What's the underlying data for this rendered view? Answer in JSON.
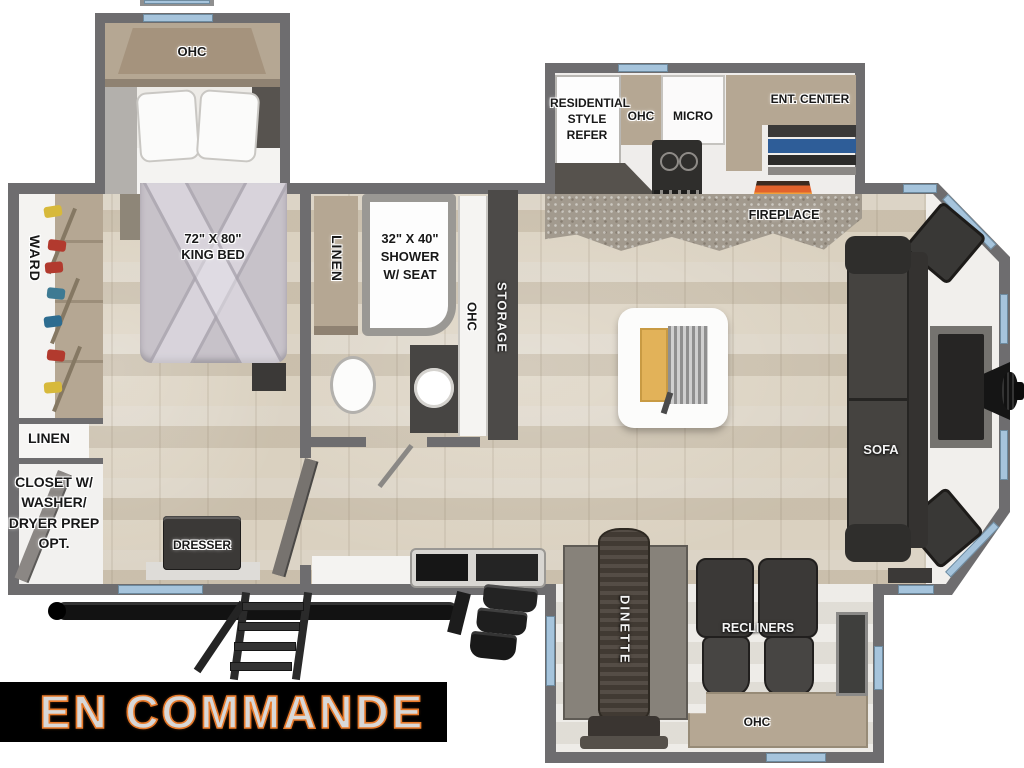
{
  "plan": {
    "bedroom": {
      "slide_ohc": "OHC",
      "king_bed": [
        "72\" X 80\"",
        "KING BED"
      ],
      "ward": "WARD",
      "linen": "LINEN",
      "closet": [
        "CLOSET W/",
        "WASHER/",
        "DRYER PREP",
        "OPT."
      ],
      "dresser": "DRESSER"
    },
    "bathroom": {
      "linen": "LINEN",
      "shower": [
        "32\" X 40\"",
        "SHOWER",
        "W/ SEAT"
      ]
    },
    "hall": {
      "ohc": "OHC",
      "storage": "STORAGE"
    },
    "kitchen": {
      "refer": [
        "RESIDENTIAL",
        "STYLE",
        "REFER"
      ],
      "ohc": "OHC",
      "micro": "MICRO",
      "ent_center": "ENT. CENTER",
      "fireplace": "FIREPLACE"
    },
    "living": {
      "sofa": "SOFA"
    },
    "dinette_slide": {
      "dinette": "DINETTE",
      "recliners": "RECLINERS",
      "ohc": "OHC"
    },
    "banner": {
      "text": "EN COMMANDE"
    }
  },
  "colors": {
    "wall": "#6e6d6f",
    "floor": "#d2c8b6",
    "window_blue": "#a6c4dc",
    "cabinet_tan": "#b5a793",
    "dark_furniture": "#3b3937",
    "shelf_blue": "#2e5d98",
    "flame_orange": "#e2622c",
    "banner_bg": "#000000",
    "banner_text": "#d8d8d8",
    "banner_outline": "#e87a2a"
  }
}
